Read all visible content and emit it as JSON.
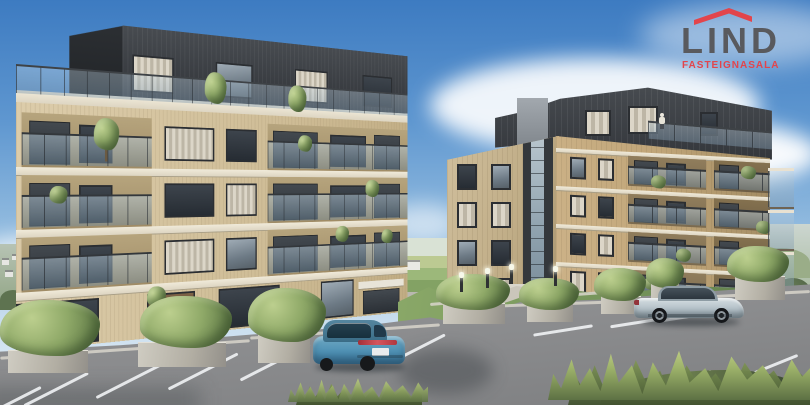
{
  "brand": {
    "name": "LIND",
    "tagline": "FASTEIGNASALA",
    "name_color": "#595A5E",
    "accent_color": "#E2454C",
    "icon": "roof-icon"
  },
  "scene": {
    "type": "architectural-render",
    "subject": "Two modern apartment buildings with landscaped parking area, blue sky and distant fields",
    "buildings": [
      {
        "id": "left-building",
        "visible_floors": 5,
        "facade_color": "#D4C19E",
        "penthouse_color": "#3B3F44",
        "features": [
          "dark set-back penthouse",
          "glass balcony railings",
          "roof terrace shrubs",
          "balcony plants"
        ]
      },
      {
        "id": "right-building",
        "visible_floors": 6,
        "facade_color": "#C2A87F",
        "penthouse_color": "#4B4F54",
        "features": [
          "glass stairwell tower",
          "protruding side balconies",
          "roof terrace with person"
        ]
      }
    ],
    "vehicles": [
      {
        "id": "blue-sedan",
        "color": "#4E8FB2",
        "state": "parked"
      },
      {
        "id": "silver-coupe",
        "color": "#B7C2C9",
        "state": "parked"
      }
    ],
    "environment": {
      "sky_top": "#3D7BC1",
      "sky_horizon": "#E6F0F6",
      "cloud": "#FFFFFF",
      "asphalt": "#8D8E90",
      "parking_line": "#EEF0F2",
      "lawn": "#7D9A5F",
      "shrub": "#8FA968",
      "planter_stone": "#B5B1A6",
      "distant_field": "#9AB478",
      "distant_hill": "#8FA38A"
    }
  }
}
